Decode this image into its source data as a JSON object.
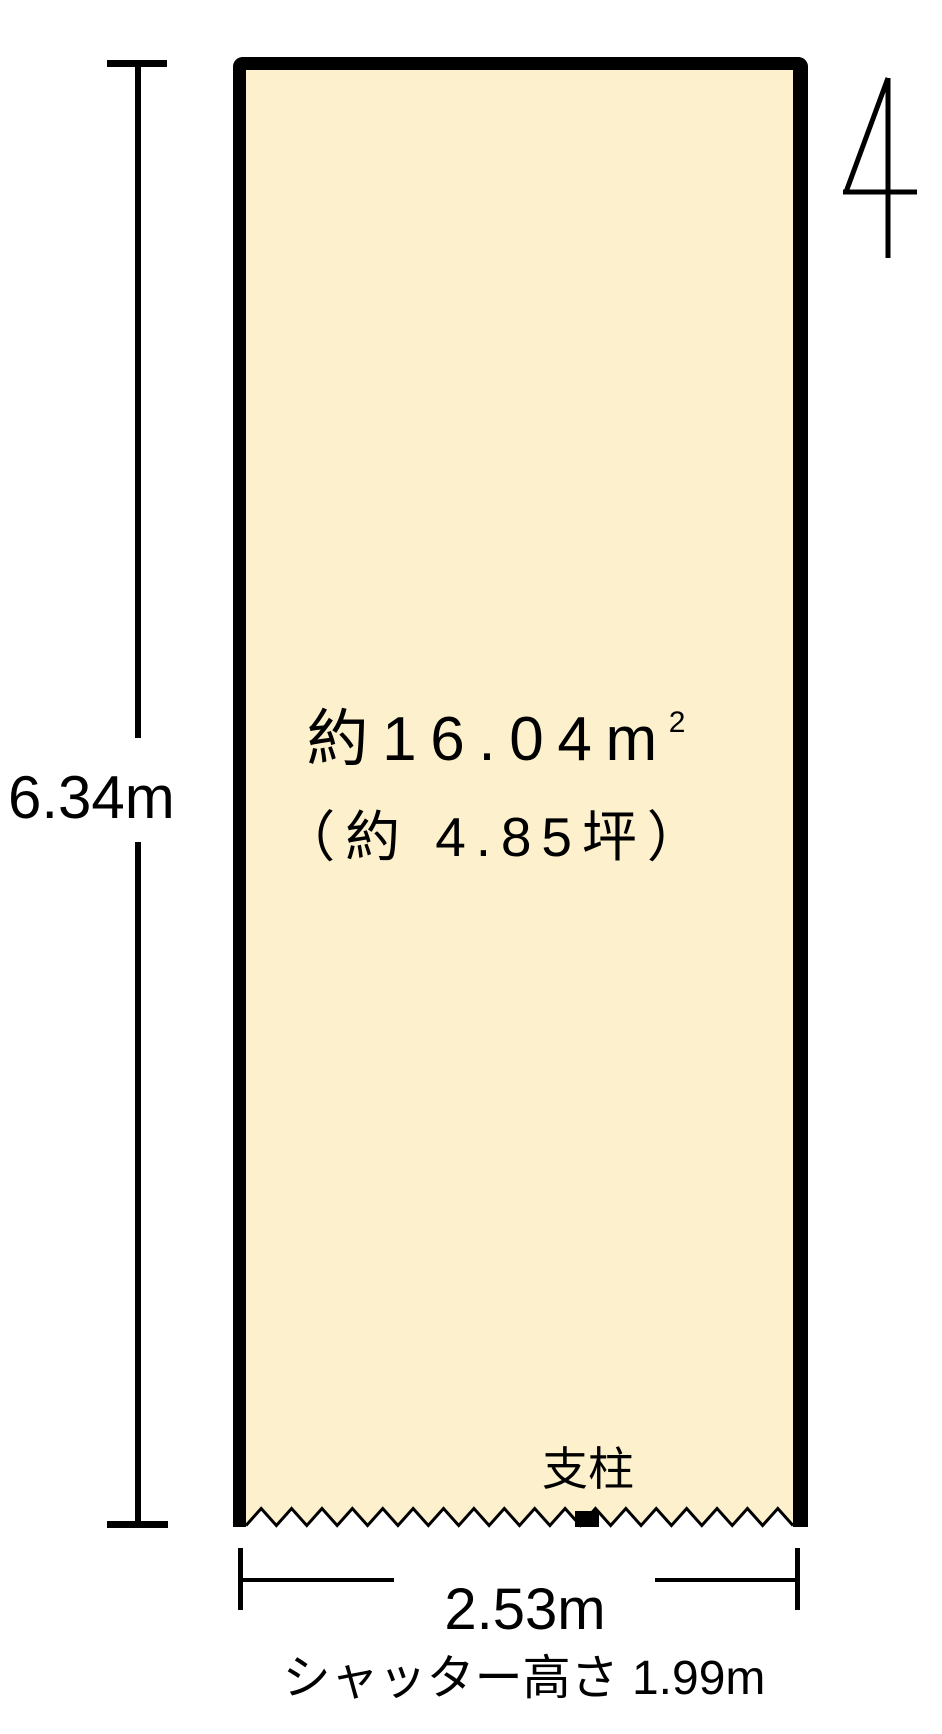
{
  "unit": {
    "number": "4",
    "area_m2_value": "約16.04",
    "area_m2_unit_base": "m",
    "area_m2_unit_exponent": "2",
    "area_tsubo": "（約 4.85坪）",
    "pillar_label": "支柱"
  },
  "dimensions": {
    "height_label": "6.34m",
    "width_label": "2.53m",
    "shutter_height_label": "シャッター高さ 1.99m"
  },
  "colors": {
    "unit_fill": "#fcf0cd",
    "line": "#000000"
  }
}
